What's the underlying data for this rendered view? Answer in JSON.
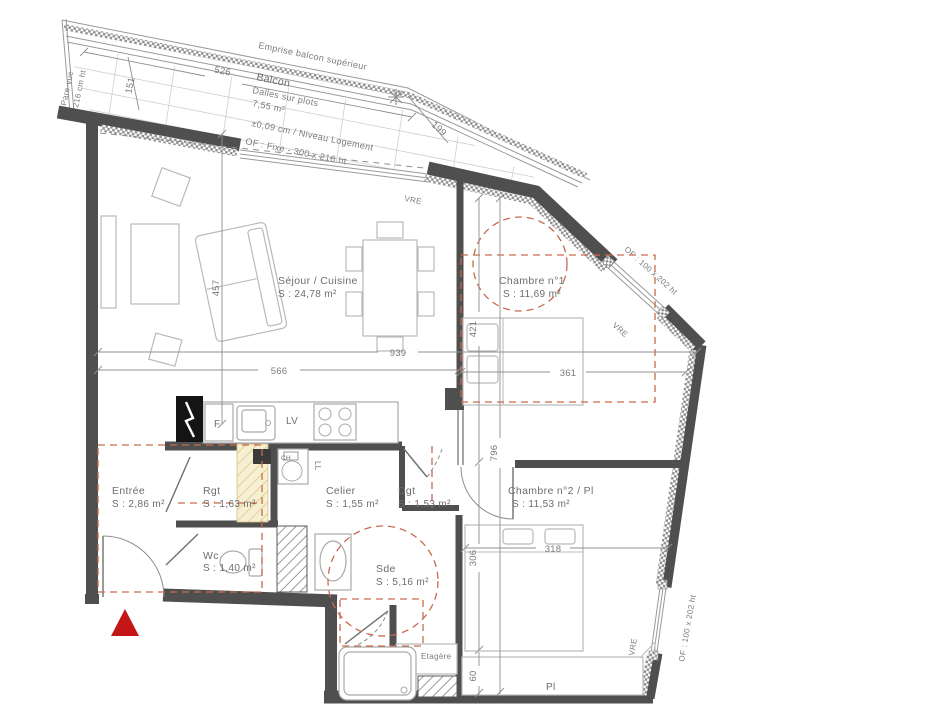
{
  "balcony": {
    "emprise": "Emprise balcon supérieur",
    "name": "Balcon",
    "floor": "Dalles sur plots",
    "area": "7,55 m²",
    "level": "±0,09 cm / Niveau Logement",
    "window": "OF : Fixe - 300 x 216 ht",
    "pare_vue_line1": "Pare-vue",
    "pare_vue_line2": "216 cm ht"
  },
  "rooms": {
    "sejour": {
      "name": "Séjour / Cuisine",
      "area": "S : 24,78 m²"
    },
    "chambre1": {
      "name": "Chambre n°1",
      "area": "S : 11,69 m²"
    },
    "chambre2": {
      "name": "Chambre n°2 / Pl",
      "area": "S : 11,53 m²"
    },
    "entree": {
      "name": "Entrée",
      "area": "S : 2,86 m²"
    },
    "rgt": {
      "name": "Rgt",
      "area": "S : 1,63 m²"
    },
    "wc": {
      "name": "Wc",
      "area": "S : 1,40 m²"
    },
    "celier": {
      "name": "Celier",
      "area": "S : 1,55 m²"
    },
    "dgt": {
      "name": "Dgt",
      "area": "S : 1,53 m²"
    },
    "sde": {
      "name": "Sde",
      "area": "S : 5,16 m²"
    }
  },
  "features": {
    "etagere": "Etagère",
    "placard": "Pl",
    "fridge": "F",
    "dishwasher": "LV",
    "washer": "LL",
    "water_heater": "CH"
  },
  "windows": {
    "vre": "VRE",
    "of_small": "OF : 100 x 202 ht"
  },
  "dimensions": {
    "balcony_526": "526",
    "balcony_151": "151",
    "balcony_199": "199",
    "sejour_457": "457",
    "sejour_939": "939",
    "sejour_566": "566",
    "ch1_421": "421",
    "ch1_361": "361",
    "right_796": "796",
    "ch2_318": "318",
    "ch2_306": "306",
    "ch2_60": "60"
  },
  "colors": {
    "wall": "#4f4f4f",
    "accessibility_dashed": "#c96a4e",
    "entrance_marker": "#c41616",
    "rgt_hatch": "#f6efd2"
  }
}
